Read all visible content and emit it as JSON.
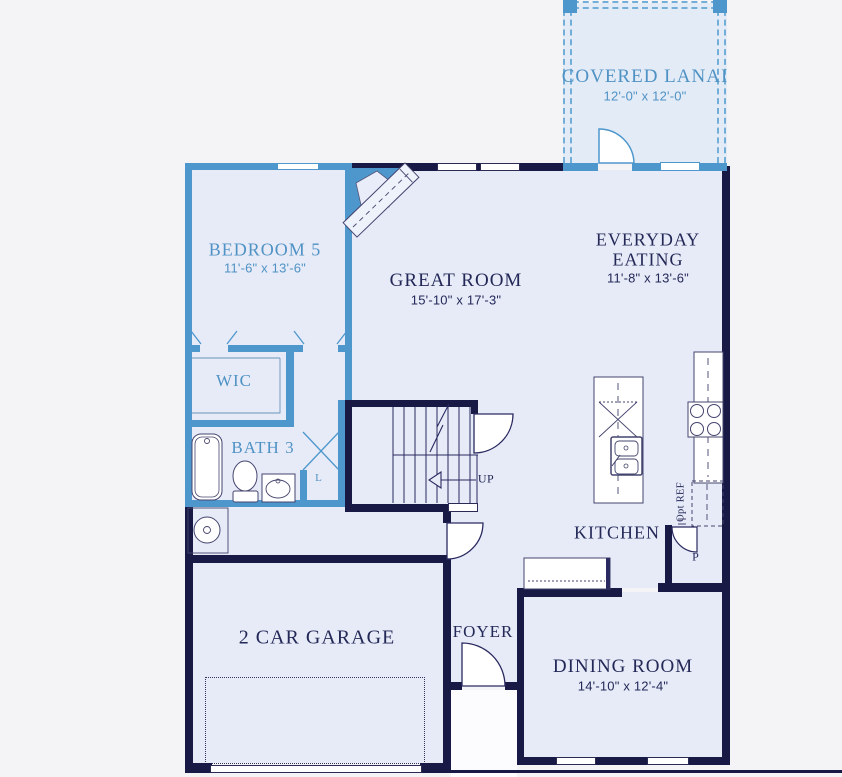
{
  "palette": {
    "wall_main": "#191945",
    "wall_option": "#4e97cc",
    "screen_dashed": "#73aed9",
    "floor": "#e7ebf8",
    "floor_lanai": "#e3ebf7",
    "background": "#f4f4f6",
    "label_main": "#232857",
    "label_option": "#4f92c4"
  },
  "rooms": {
    "covered_lanai": {
      "name": "COVERED LANAI",
      "dims": "12'-0\" x 12'-0\""
    },
    "bedroom5": {
      "name": "BEDROOM 5",
      "dims": "11'-6\" x 13'-6\""
    },
    "great_room": {
      "name": "GREAT ROOM",
      "dims": "15'-10\" x 17'-3\""
    },
    "everyday_eating": {
      "name_line1": "EVERYDAY",
      "name_line2": "EATING",
      "dims": "11'-8\" x 13'-6\""
    },
    "wic": {
      "name": "WIC"
    },
    "bath3": {
      "name": "BATH 3"
    },
    "kitchen": {
      "name": "KITCHEN"
    },
    "garage": {
      "name": "2 CAR GARAGE"
    },
    "foyer": {
      "name": "FOYER"
    },
    "dining_room": {
      "name": "DINING ROOM",
      "dims": "14'-10\" x 12'-4\""
    }
  },
  "annotations": {
    "stairs_up": "UP",
    "opt_ref": "Opt REF",
    "pantry": "P",
    "linen": "L"
  }
}
